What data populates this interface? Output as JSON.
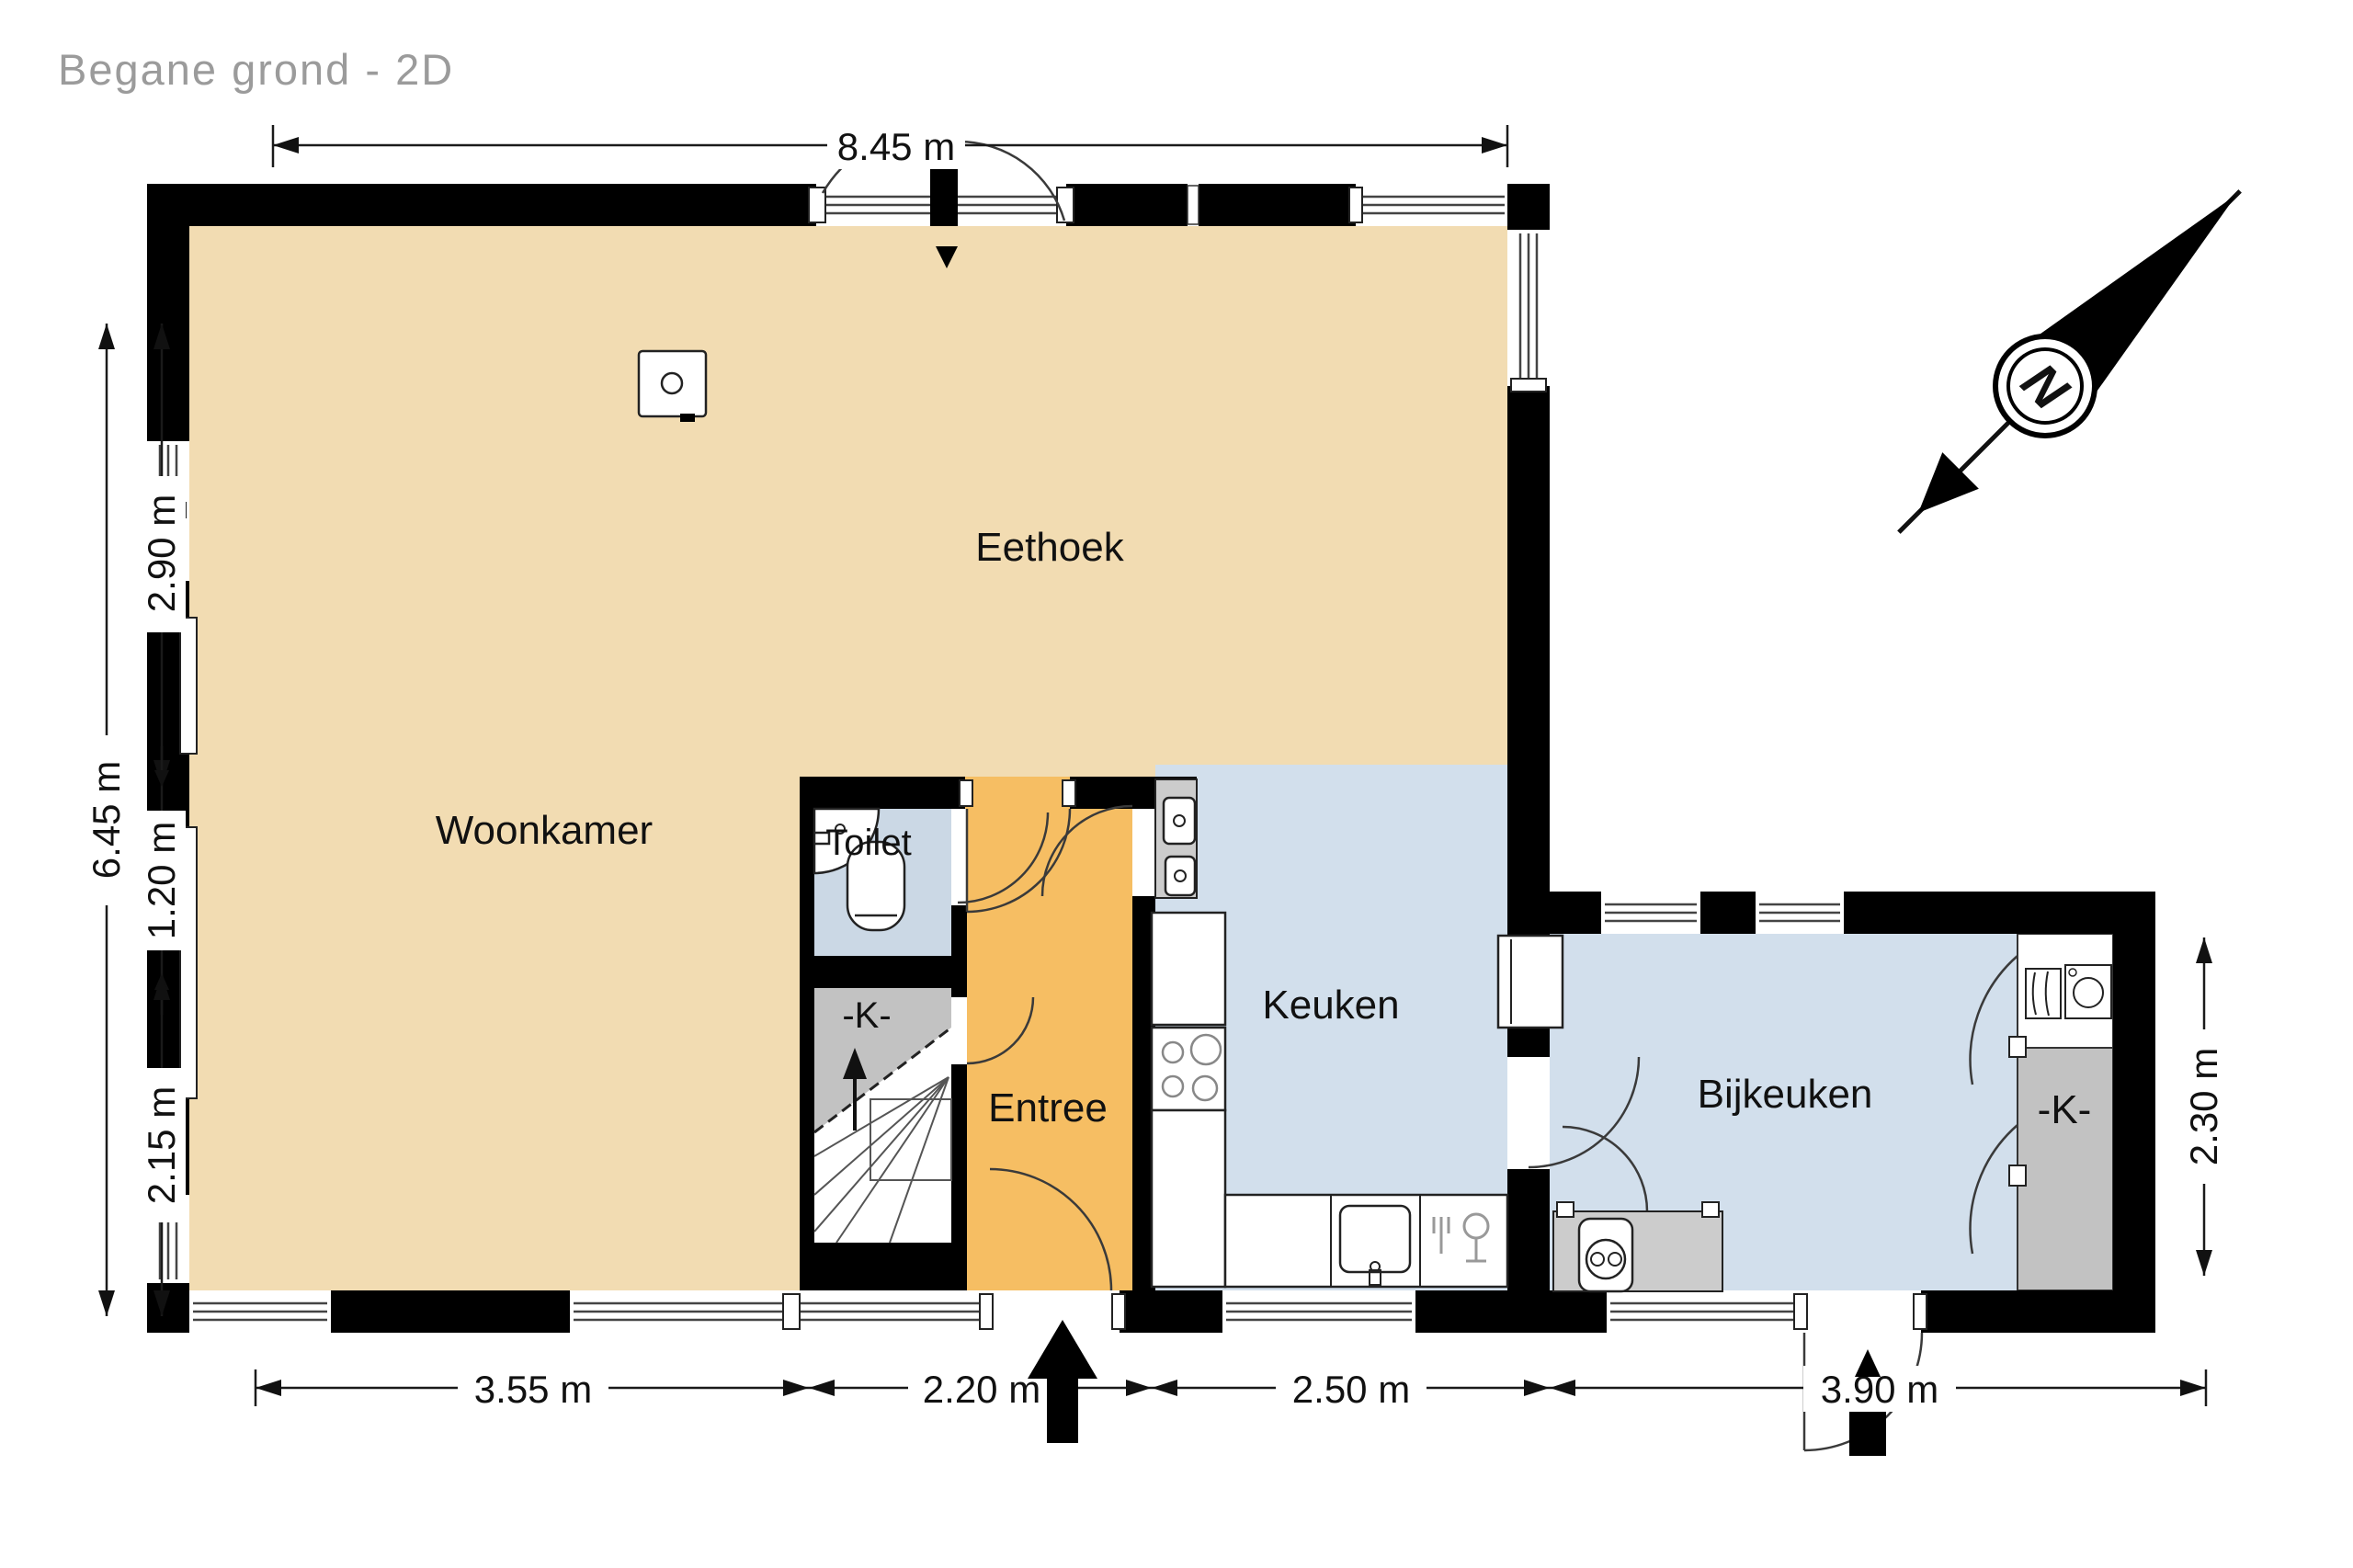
{
  "title": "Begane grond - 2D",
  "compass": {
    "north_label": "N"
  },
  "rooms": {
    "eethoek": {
      "label": "Eethoek"
    },
    "woonkamer": {
      "label": "Woonkamer"
    },
    "toilet": {
      "label": "Toilet"
    },
    "entree": {
      "label": "Entree"
    },
    "keuken": {
      "label": "Keuken"
    },
    "bijkeuken": {
      "label": "Bijkeuken"
    },
    "hal_closet": {
      "label": "-K-"
    },
    "bijkeuken_closet": {
      "label": "-K-"
    }
  },
  "dimensions": {
    "top_width": "8.45 m",
    "left_total": "6.45 m",
    "left_upper": "2.90 m",
    "left_middle": "1.20 m",
    "left_lower": "2.15 m",
    "bottom_woonkamer": "3.55 m",
    "bottom_entree": "2.20 m",
    "bottom_keuken": "2.50 m",
    "bottom_bijkeuken": "3.90 m",
    "right_bijkeuken": "2.30 m"
  },
  "colors": {
    "living_floor": "#F2DCB2",
    "entry_floor": "#F6BE63",
    "kitchen_floor": "#D2DFEC",
    "toilet_floor": "#CBD8E5",
    "closet_gray": "#C2C2C2",
    "counter_gray": "#CCCCCC",
    "wall_black": "#000000",
    "title_gray": "#9B9B9B"
  }
}
